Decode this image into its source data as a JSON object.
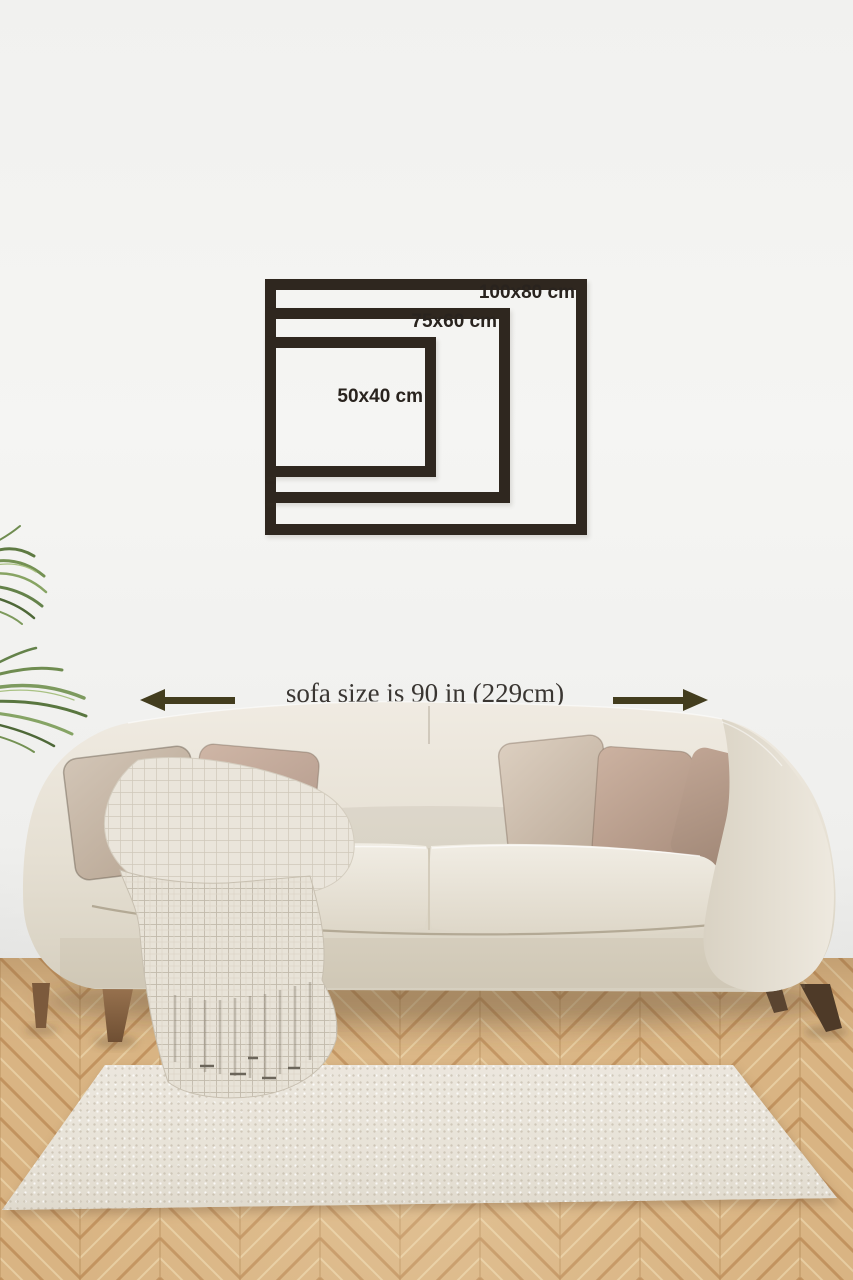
{
  "frame_size_guide": {
    "frames": [
      {
        "label": "100x80 cm"
      },
      {
        "label": "75x60 cm"
      },
      {
        "label": "50x40 cm"
      }
    ],
    "frame_color": "#2f271f",
    "label_color": "#29231e"
  },
  "sofa_dimension": {
    "label": "sofa size is 90 in (229cm)",
    "arrow_color": "#433d1e",
    "left_arrow_icon": "arrow-pointing-left",
    "right_arrow_icon": "arrow-pointing-right"
  },
  "scene_colors": {
    "wall": "#f2f2f0",
    "floor_wood": "#d9b483",
    "rug": "#e9e4da",
    "sofa_fabric": "#e9e3d8",
    "pillow_tones": [
      "#cabdae",
      "#c4aa9b",
      "#d3c4b5",
      "#c2a795",
      "#b29788"
    ],
    "throw_knit": "#e8e3d8",
    "plant_green": "#6f8c50"
  }
}
